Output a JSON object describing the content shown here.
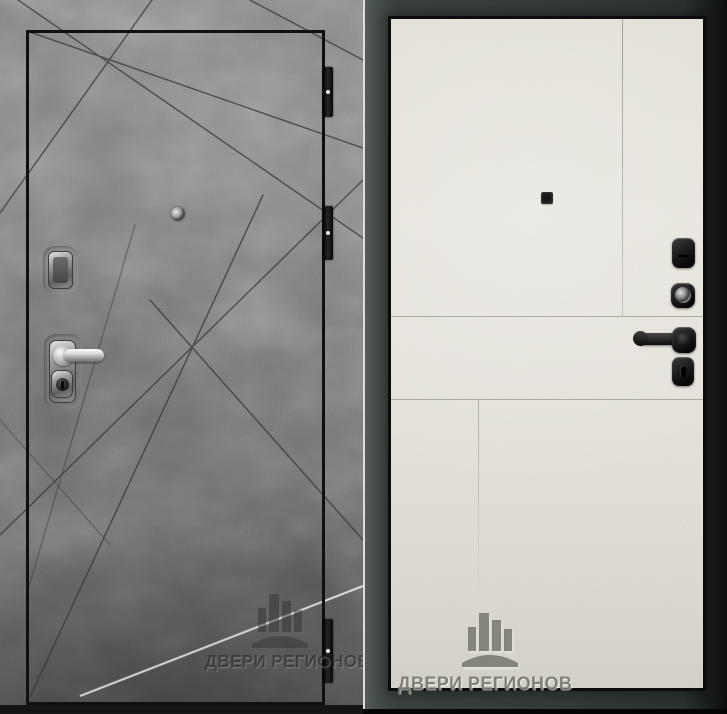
{
  "image": {
    "type": "product-photo",
    "subject": "steel entry door shown from both sides",
    "views": [
      {
        "id": "front",
        "label": "front side - gray concrete finish with diagonal milled lines"
      },
      {
        "id": "back",
        "label": "back side - cream white panel in dark frame"
      }
    ]
  },
  "watermark": {
    "brand_text": "ДВЕРИ РЕГИОНОВ",
    "logo": "buildings-over-arc-logo"
  },
  "hardware": {
    "front": [
      "top-lock-cover",
      "lever-handle-chrome",
      "key-cylinder",
      "peephole",
      "hinges-x3"
    ],
    "back": [
      "flip-lock-cover",
      "round-keyhole",
      "lever-handle-black",
      "thumb-turn",
      "peephole"
    ]
  },
  "colors": {
    "concrete_gray": "#7b7b7b",
    "door_edge_black": "#101010",
    "frame_dark_slate": "#333b38",
    "panel_cream": "#e7e5dd",
    "chrome": "#d0d0d0",
    "hardware_black": "#161616",
    "highlight_line": "#e4e4e4"
  }
}
